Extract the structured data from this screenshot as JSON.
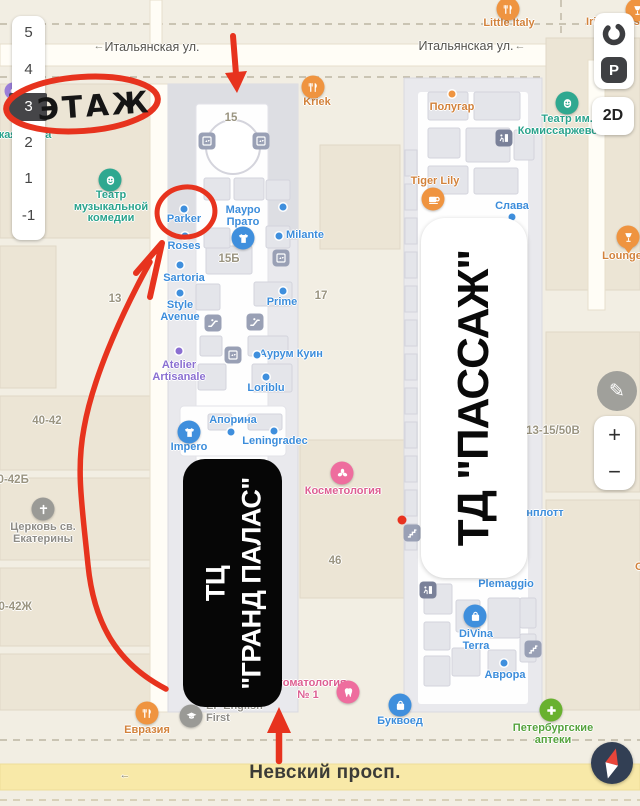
{
  "accents": {
    "annotation_red": "#e7331e",
    "poi_orange": "#d2823b",
    "poi_blue": "#3f8edb",
    "poi_teal": "#2fa28b",
    "poi_pink": "#e0618f",
    "poi_green": "#55a23c",
    "poi_purple": "#8a6fd1",
    "road_yellow": "#f8e9a8",
    "ui_dark": "#3f4043"
  },
  "ui": {
    "floor_selector": {
      "floors": [
        "5",
        "4",
        "3",
        "2",
        "1",
        "-1"
      ],
      "selected": "3"
    },
    "parking_label": "P",
    "mode_label": "2D",
    "zoom_in": "+",
    "zoom_out": "−",
    "edit_icon": "edit-pencil-icon",
    "compass_icon": "compass-icon",
    "ring_icon": "route-ring-icon"
  },
  "annotations": {
    "floor_note": "ЭТАЖ"
  },
  "overlays": {
    "grand_palace": {
      "line1": "ТЦ",
      "line2": "\"ГРАНД ПАЛАС\""
    },
    "passage": {
      "text": "ТД \"ПАССАЖ\""
    }
  },
  "map": {
    "pois": [
      {
        "n": "little-italy",
        "t": [
          "Little Italy"
        ],
        "x": 509,
        "y": 24,
        "c": "orange",
        "icon": {
          "k": "restaurant-icon",
          "x": 508,
          "y": 9
        }
      },
      {
        "n": "irish-house",
        "t": [
          "Irish House"
        ],
        "x": 616,
        "y": 23,
        "c": "orange",
        "icon": {
          "k": "wine-icon",
          "x": 637,
          "y": 10
        }
      },
      {
        "n": "kriek",
        "t": [
          "Kriek"
        ],
        "x": 317,
        "y": 103,
        "c": "orange",
        "icon": {
          "k": "restaurant-icon",
          "x": 313,
          "y": 87
        }
      },
      {
        "n": "polugar",
        "t": [
          "Полугар"
        ],
        "x": 452,
        "y": 108,
        "c": "orange",
        "dot": {
          "x": 452,
          "y": 94
        }
      },
      {
        "n": "tiger-lily",
        "t": [
          "Tiger Lily"
        ],
        "x": 435,
        "y": 182,
        "c": "orange",
        "icon": {
          "k": "coffee-icon",
          "x": 433,
          "y": 199
        }
      },
      {
        "n": "lounger",
        "t": [
          "LoungeR"
        ],
        "x": 626,
        "y": 257,
        "c": "orange",
        "icon": {
          "k": "wine-icon",
          "x": 628,
          "y": 237,
          "pin": true
        }
      },
      {
        "n": "evrazia",
        "t": [
          "Евразия"
        ],
        "x": 147,
        "y": 731,
        "c": "orange",
        "icon": {
          "k": "restaurant-icon",
          "x": 147,
          "y": 713
        }
      },
      {
        "n": "cut-label",
        "t": [
          "С"
        ],
        "x": 639,
        "y": 568,
        "c": "orange"
      },
      {
        "n": "teatr-muzkomedii",
        "t": [
          "Театр",
          "музыкальной",
          "комедии"
        ],
        "x": 111,
        "y": 196,
        "c": "teal",
        "icon": {
          "k": "theater-icon",
          "x": 110,
          "y": 180
        }
      },
      {
        "n": "teatr-komissarzhevskoy",
        "t": [
          "Театр им.",
          "Комиссаржевской"
        ],
        "x": 567,
        "y": 120,
        "c": "teal",
        "icon": {
          "k": "theater-icon",
          "x": 567,
          "y": 103
        }
      },
      {
        "n": "russkaya-ikona",
        "t": [
          "усская икона"
        ],
        "x": 16,
        "y": 136,
        "c": "teal"
      },
      {
        "n": "parker",
        "t": [
          "Parker"
        ],
        "x": 184,
        "y": 220,
        "c": "blue",
        "dot": {
          "x": 184,
          "y": 209
        }
      },
      {
        "n": "roses",
        "t": [
          "Roses"
        ],
        "x": 184,
        "y": 247,
        "c": "blue",
        "dot": {
          "x": 185,
          "y": 236
        }
      },
      {
        "n": "mauro-prato",
        "t": [
          "Мауро",
          "Прато"
        ],
        "x": 243,
        "y": 211,
        "c": "blue",
        "icon": {
          "k": "clothing-icon",
          "x": 243,
          "y": 238
        }
      },
      {
        "n": "milante",
        "t": [
          "Milante"
        ],
        "x": 305,
        "y": 236,
        "c": "blue",
        "dot": {
          "x": 279,
          "y": 236
        }
      },
      {
        "n": "sartoria",
        "t": [
          "Sartoria"
        ],
        "x": 184,
        "y": 279,
        "c": "blue",
        "dot": {
          "x": 180,
          "y": 265
        }
      },
      {
        "n": "style-avenue",
        "t": [
          "Style",
          "Avenue"
        ],
        "x": 180,
        "y": 306,
        "c": "blue",
        "dot": {
          "x": 180,
          "y": 293
        }
      },
      {
        "n": "prime",
        "t": [
          "Prime"
        ],
        "x": 282,
        "y": 303,
        "c": "blue",
        "dot": {
          "x": 283,
          "y": 291
        }
      },
      {
        "n": "aurum-kuin",
        "t": [
          "Аурум Куин"
        ],
        "x": 291,
        "y": 355,
        "c": "blue",
        "dot": {
          "x": 257,
          "y": 355
        }
      },
      {
        "n": "loriblu",
        "t": [
          "Loriblu"
        ],
        "x": 266,
        "y": 389,
        "c": "blue",
        "dot": {
          "x": 266,
          "y": 377
        }
      },
      {
        "n": "aporina",
        "t": [
          "Апорина"
        ],
        "x": 233,
        "y": 421,
        "c": "blue",
        "dot": {
          "x": 231,
          "y": 432
        }
      },
      {
        "n": "impero",
        "t": [
          "Impero"
        ],
        "x": 189,
        "y": 448,
        "c": "blue",
        "icon": {
          "k": "clothing-icon",
          "x": 189,
          "y": 432
        }
      },
      {
        "n": "leningradec",
        "t": [
          "Leningradec"
        ],
        "x": 275,
        "y": 442,
        "c": "blue",
        "dot": {
          "x": 274,
          "y": 431
        }
      },
      {
        "n": "slava",
        "t": [
          "Слава"
        ],
        "x": 512,
        "y": 207,
        "c": "blue",
        "dot": {
          "x": 512,
          "y": 217
        }
      },
      {
        "n": "plemaggio",
        "t": [
          "Plemaggio"
        ],
        "x": 506,
        "y": 585,
        "c": "blue"
      },
      {
        "n": "divina-terra",
        "t": [
          "DiVina",
          "Terra"
        ],
        "x": 476,
        "y": 635,
        "c": "blue",
        "icon": {
          "k": "bag-icon",
          "x": 475,
          "y": 616
        }
      },
      {
        "n": "avrora",
        "t": [
          "Аврора"
        ],
        "x": 505,
        "y": 676,
        "c": "blue",
        "dot": {
          "x": 504,
          "y": 663
        }
      },
      {
        "n": "bukvoed",
        "t": [
          "Буквоед"
        ],
        "x": 400,
        "y": 722,
        "c": "blue",
        "icon": {
          "k": "bag-icon",
          "x": 400,
          "y": 705
        }
      },
      {
        "n": "shenplott",
        "t": [
          "нплотт"
        ],
        "x": 545,
        "y": 514,
        "c": "blue"
      },
      {
        "n": "kosmetologia",
        "t": [
          "Косметология"
        ],
        "x": 343,
        "y": 492,
        "c": "pink",
        "icon": {
          "k": "flower-icon",
          "x": 342,
          "y": 473
        }
      },
      {
        "n": "stomatologia",
        "t": [
          "Стоматология",
          "№ 1"
        ],
        "x": 308,
        "y": 684,
        "c": "pink",
        "icon": {
          "k": "tooth-icon",
          "x": 348,
          "y": 692
        }
      },
      {
        "n": "peterburgskie-apteki",
        "t": [
          "Петербургские",
          "аптеки"
        ],
        "x": 553,
        "y": 729,
        "c": "green",
        "icon": {
          "k": "plus-icon",
          "x": 551,
          "y": 710
        }
      },
      {
        "n": "atelier-artisanale",
        "t": [
          "Atelier",
          "Artisanale"
        ],
        "x": 179,
        "y": 366,
        "c": "purple",
        "dot": {
          "x": 179,
          "y": 351
        }
      },
      {
        "n": "ef-english-first",
        "t": [
          "EF English",
          "First"
        ],
        "x": 206,
        "y": 707,
        "c": "gray",
        "la": true,
        "icon": {
          "k": "school-icon",
          "x": 191,
          "y": 716
        }
      },
      {
        "n": "tserkov-ekateriny",
        "t": [
          "Церковь св.",
          "Екатерины"
        ],
        "x": 43,
        "y": 528,
        "c": "gray",
        "icon": {
          "k": "church-icon",
          "x": 43,
          "y": 509
        }
      },
      {
        "n": "bldg-15",
        "t": [
          "15"
        ],
        "x": 231,
        "y": 119,
        "c": "num"
      },
      {
        "n": "bldg-15b",
        "t": [
          "15Б"
        ],
        "x": 229,
        "y": 260,
        "c": "num"
      },
      {
        "n": "bldg-17",
        "t": [
          "17"
        ],
        "x": 321,
        "y": 297,
        "c": "num"
      },
      {
        "n": "bldg-13",
        "t": [
          "13"
        ],
        "x": 115,
        "y": 300,
        "c": "num"
      },
      {
        "n": "bldg-46",
        "t": [
          "46"
        ],
        "x": 335,
        "y": 562,
        "c": "num"
      },
      {
        "n": "bldg-40-42",
        "t": [
          "40-42"
        ],
        "x": 47,
        "y": 422,
        "c": "num"
      },
      {
        "n": "bldg-40-42b",
        "t": [
          "40-42Б"
        ],
        "x": 10,
        "y": 481,
        "c": "num"
      },
      {
        "n": "bldg-40-42zh",
        "t": [
          "40-42Ж"
        ],
        "x": 12,
        "y": 608,
        "c": "num"
      },
      {
        "n": "bldg-13-15-50v",
        "t": [
          "13-15/50В"
        ],
        "x": 553,
        "y": 432,
        "c": "num"
      },
      {
        "n": "street-italyanskaya-left",
        "t": [
          "Итальянская ул."
        ],
        "x": 152,
        "y": 48,
        "c": "street"
      },
      {
        "n": "street-italyanskaya-right",
        "t": [
          "Итальянская ул."
        ],
        "x": 466,
        "y": 47,
        "c": "street"
      },
      {
        "n": "street-arrow-left",
        "t": [
          "←"
        ],
        "x": 99,
        "y": 47,
        "c": "street-arrow"
      },
      {
        "n": "street-arrow-right",
        "t": [
          "←"
        ],
        "x": 520,
        "y": 47,
        "c": "street-arrow"
      },
      {
        "n": "street-arrow-nevsky",
        "t": [
          "←"
        ],
        "x": 125,
        "y": 776,
        "c": "street-arrow"
      },
      {
        "n": "street-nevsky",
        "t": [
          "Невский просп."
        ],
        "x": 325,
        "y": 777,
        "c": "street-major"
      }
    ],
    "util_icons": [
      {
        "k": "elevator-icon",
        "x": 207,
        "y": 141
      },
      {
        "k": "elevator-icon",
        "x": 261,
        "y": 141
      },
      {
        "k": "elevator-icon",
        "x": 281,
        "y": 258
      },
      {
        "k": "elevator-icon",
        "x": 233,
        "y": 355
      },
      {
        "k": "escalator-icon",
        "x": 213,
        "y": 323
      },
      {
        "k": "escalator-icon",
        "x": 255,
        "y": 322
      },
      {
        "k": "stairs-icon",
        "x": 412,
        "y": 533
      },
      {
        "k": "stairs-icon",
        "x": 533,
        "y": 649
      },
      {
        "k": "exit-icon",
        "x": 504,
        "y": 138,
        "dark": true
      },
      {
        "k": "exit-icon",
        "x": 428,
        "y": 590,
        "dark": true
      },
      {
        "k": "poi-purple-icon",
        "x": 13,
        "y": 91,
        "circle": true
      }
    ],
    "dots": [
      {
        "n": "shop-dot",
        "x": 283,
        "y": 207,
        "c": "blue"
      },
      {
        "n": "entrance-dot",
        "x": 402,
        "y": 520,
        "c": "red"
      }
    ]
  }
}
